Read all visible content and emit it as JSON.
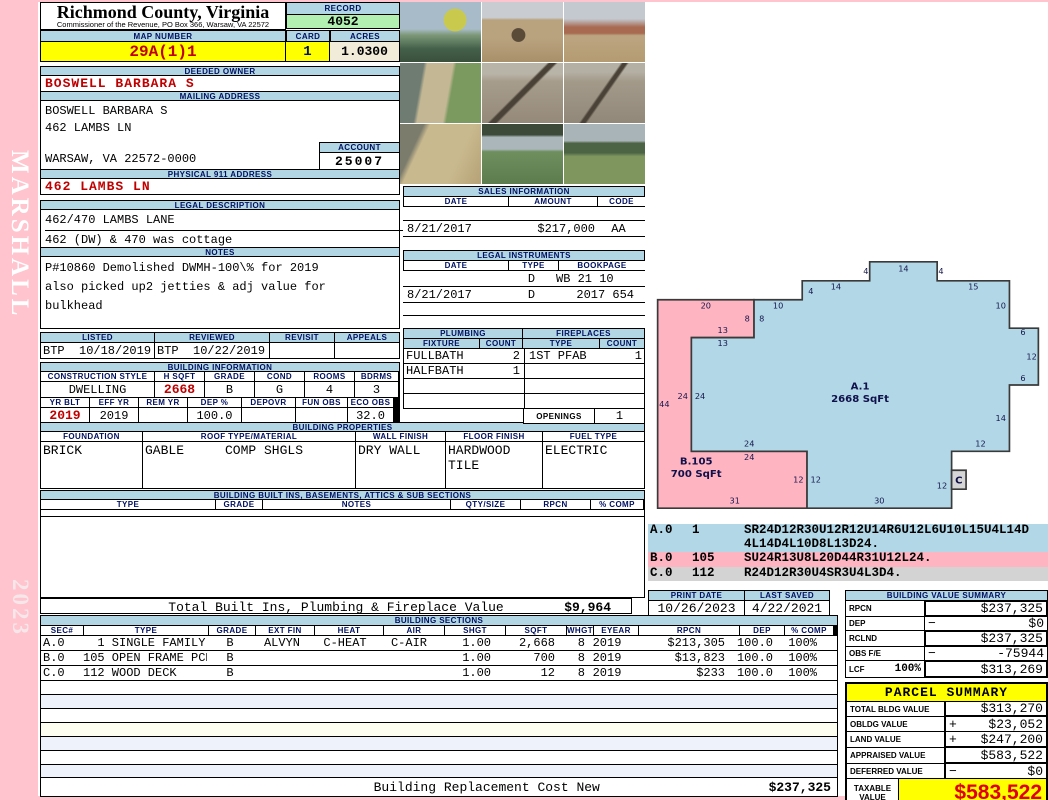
{
  "sidebar": {
    "vertical_top": "MARSHALL",
    "vertical_bottom": "2023"
  },
  "title": {
    "name": "Richmond County, Virginia",
    "subtitle": "Commissioner of the Revenue, PO Box 366, Warsaw, VA 22572"
  },
  "record": {
    "label": "RECORD",
    "value": "4052"
  },
  "map": {
    "label": "MAP NUMBER",
    "value": "29A(1)1",
    "card_label": "CARD",
    "card_value": "1",
    "acres_label": "ACRES",
    "acres_value": "1.0300"
  },
  "owner": {
    "deeded_label": "DEEDED OWNER",
    "deeded": "BOSWELL BARBARA S",
    "mailing_label": "MAILING ADDRESS",
    "mailing_line1": "BOSWELL BARBARA S",
    "mailing_line2": "462 LAMBS LN",
    "mailing_line3": "WARSAW, VA 22572-0000",
    "account_label": "ACCOUNT",
    "account": "25007",
    "physical_label": "PHYSICAL 911 ADDRESS",
    "physical": "462 LAMBS LN"
  },
  "legal": {
    "label": "LEGAL DESCRIPTION",
    "line1": "462/470 LAMBS LANE",
    "line2": "462 (DW) & 470 was cottage",
    "notes_label": "NOTES",
    "notes_line1": "P#10860 Demolished DWMH-100\\% for 2019",
    "notes_line2": "also picked up2 jetties & adj value for",
    "notes_line3": "bulkhead"
  },
  "review": {
    "listed_label": "LISTED",
    "listed": "BTP  10/18/2019",
    "reviewed_label": "REVIEWED",
    "reviewed": "BTP  10/22/2019",
    "revisit_label": "REVISIT",
    "revisit": "",
    "appeals_label": "APPEALS",
    "appeals": ""
  },
  "building_info": {
    "label": "BUILDING INFORMATION",
    "h1": [
      "CONSTRUCTION STYLE",
      "H SQFT",
      "GRADE",
      "COND",
      "ROOMS",
      "BDRMS"
    ],
    "v1": [
      "DWELLING",
      "2668",
      "B",
      "G",
      "4",
      "3"
    ],
    "h2": [
      "YR BLT",
      "EFF YR",
      "REM YR",
      "DEP %",
      "DEPOVR",
      "FUN OBS",
      "ECO OBS"
    ],
    "v2": [
      "2019",
      "2019",
      "",
      "100.0",
      "",
      "",
      "32.0"
    ]
  },
  "building_props": {
    "label": "BUILDING PROPERTIES",
    "headers": [
      "FOUNDATION",
      "ROOF TYPE/MATERIAL",
      "WALL FINISH",
      "FLOOR FINISH",
      "FUEL TYPE"
    ],
    "foundation": "BRICK",
    "roof_type": "GABLE",
    "roof_material": "COMP SHGLS",
    "wall": "DRY WALL",
    "floor_line1": "HARDWOOD",
    "floor_line2": "TILE",
    "fuel": "ELECTRIC"
  },
  "built_ins": {
    "label": "BUILDING BUILT INS, BASEMENTS, ATTICS & SUB SECTIONS",
    "headers": [
      "TYPE",
      "GRADE",
      "NOTES",
      "QTY/SIZE",
      "RPCN",
      "% COMP"
    ],
    "total_label": "Total Built Ins, Plumbing & Fireplace Value",
    "total_value": "$9,964"
  },
  "photos": {
    "items": [
      "waterfront tree",
      "construction sand",
      "brick foundation",
      "shore erosion",
      "water jetty",
      "water jetty far",
      "bulkhead sand",
      "lawn waterfront",
      "field trees"
    ]
  },
  "sales": {
    "label": "SALES INFORMATION",
    "headers": [
      "DATE",
      "AMOUNT",
      "CODE"
    ],
    "rows": [
      [
        "",
        "",
        ""
      ],
      [
        "8/21/2017",
        "$217,000",
        "AA"
      ],
      [
        "",
        "",
        ""
      ]
    ]
  },
  "instruments": {
    "label": "LEGAL INSTRUMENTS",
    "headers": [
      "DATE",
      "TYPE",
      "BOOKPAGE"
    ],
    "rows": [
      [
        "",
        "D",
        "WB 21 10"
      ],
      [
        "8/21/2017",
        "D",
        "2017 654"
      ],
      [
        "",
        "",
        ""
      ]
    ]
  },
  "plumbing": {
    "label": "PLUMBING",
    "fixture_label": "FIXTURE",
    "count_label": "COUNT",
    "rows": [
      [
        "FULLBATH",
        "2"
      ],
      [
        "HALFBATH",
        "1"
      ],
      [
        "",
        ""
      ],
      [
        "",
        ""
      ]
    ]
  },
  "fireplaces": {
    "label": "FIREPLACES",
    "type_label": "TYPE",
    "count_label": "COUNT",
    "rows": [
      [
        "1ST PFAB",
        "1"
      ],
      [
        "",
        ""
      ],
      [
        "",
        ""
      ],
      [
        "",
        ""
      ]
    ],
    "openings_label": "OPENINGS",
    "openings": "1"
  },
  "sketch": {
    "a_points": "0,0 24,0 24,12 54,12 54,0 66,0 66,-14 72,-14 72,-26 66,-26 66,-36 51,-36 51,-40 37,-40 37,-36 23,-36 23,-32 13,-32 13,-24 0,-24",
    "b_points": "0,0 0,-24 13,-24 13,-32 -7,-32 -7,12 24,12 24,0",
    "c_points": "54,4 57,4 57,8 54,8",
    "dim_labels": [
      {
        "t": "4",
        "u": 36.2,
        "v": -37.4
      },
      {
        "t": "14",
        "u": 44,
        "v": -38
      },
      {
        "t": "4",
        "u": 51.8,
        "v": -37.4
      },
      {
        "t": "14",
        "u": 30,
        "v": -34.2
      },
      {
        "t": "15",
        "u": 58.5,
        "v": -34.2
      },
      {
        "t": "4",
        "u": 24.8,
        "v": -33.2
      },
      {
        "t": "10",
        "u": 18,
        "v": -30.2
      },
      {
        "t": "20",
        "u": 3,
        "v": -30.2
      },
      {
        "t": "8",
        "u": 11.6,
        "v": -27.4
      },
      {
        "t": "8",
        "u": 14.6,
        "v": -27.4
      },
      {
        "t": "13",
        "u": 6.5,
        "v": -25
      },
      {
        "t": "13",
        "u": 6.5,
        "v": -22.2
      },
      {
        "t": "24",
        "u": -1.8,
        "v": -11
      },
      {
        "t": "24",
        "u": 1.8,
        "v": -11
      },
      {
        "t": "44",
        "u": -5.6,
        "v": -9.4
      },
      {
        "t": "24",
        "u": 12,
        "v": -1
      },
      {
        "t": "24",
        "u": 12,
        "v": 1.8
      },
      {
        "t": "12",
        "u": 22.2,
        "v": 6.6
      },
      {
        "t": "12",
        "u": 25.8,
        "v": 6.6
      },
      {
        "t": "31",
        "u": 9,
        "v": 11
      },
      {
        "t": "30",
        "u": 39,
        "v": 11
      },
      {
        "t": "12",
        "u": 52,
        "v": 7.8
      },
      {
        "t": "12",
        "u": 60,
        "v": -1
      },
      {
        "t": "14",
        "u": 64.2,
        "v": -6.4
      },
      {
        "t": "6",
        "u": 68.8,
        "v": -14.8
      },
      {
        "t": "12",
        "u": 70.6,
        "v": -19.4
      },
      {
        "t": "6",
        "u": 68.8,
        "v": -24.6
      },
      {
        "t": "10",
        "u": 64.2,
        "v": -30.2
      }
    ],
    "area_labels": [
      {
        "t": "A.1",
        "u": 35,
        "v": -13
      },
      {
        "t": "2668 SqFt",
        "u": 35,
        "v": -10.4
      },
      {
        "t": "B.105",
        "u": 1,
        "v": 2.8
      },
      {
        "t": "700 SqFt",
        "u": 1,
        "v": 5.4
      },
      {
        "t": "C",
        "u": 55.5,
        "v": 6.8
      }
    ],
    "codes": [
      {
        "sec": "A.0",
        "num": "1",
        "code1": "SR24D12R30U12R12U14R6U12L6U10L15U4L14D",
        "code2": "4L14D4L10D8L13D24."
      },
      {
        "sec": "B.0",
        "num": "105",
        "code1": "SU24R13U8L20D44R31U12L24.",
        "code2": ""
      },
      {
        "sec": "C.0",
        "num": "112",
        "code1": "R24D12R30U4SR3U4L3D4.",
        "code2": ""
      }
    ]
  },
  "print_info": {
    "print_label": "PRINT DATE",
    "print": "10/26/2023",
    "saved_label": "LAST SAVED",
    "saved": "4/22/2021"
  },
  "bvs": {
    "label": "BUILDING VALUE SUMMARY",
    "rows": [
      {
        "label": "RPCN",
        "sub": "",
        "sign": "",
        "value": "$237,325"
      },
      {
        "label": "DEP",
        "sub": "",
        "sign": "−",
        "value": "$0"
      },
      {
        "label": "RCLND",
        "sub": "",
        "sign": "",
        "value": "$237,325"
      },
      {
        "label": "OBS F/E",
        "sub": "",
        "sign": "−",
        "value": "-75944"
      },
      {
        "label": "LCF",
        "sub": "100%",
        "sign": "",
        "value": "$313,269"
      }
    ]
  },
  "sections": {
    "label": "BUILDING SECTIONS",
    "headers": [
      "SEC#",
      "TYPE",
      "GRADE",
      "EXT FIN",
      "HEAT",
      "AIR",
      "SHGT",
      "SQFT",
      "WHGT",
      "EYEAR",
      "RPCN",
      "DEP",
      "% COMP"
    ],
    "rows": [
      [
        "A.0",
        "  1 SINGLE FAMILY",
        "B",
        "ALVYN",
        "C-HEAT",
        "C-AIR",
        "1.00",
        "2,668",
        "8",
        "2019",
        "$213,305",
        "100.0",
        "100%"
      ],
      [
        "B.0",
        "105 OPEN FRAME PCH",
        "B",
        "",
        "",
        "",
        "1.00",
        "700",
        "8",
        "2019",
        "$13,823",
        "100.0",
        "100%"
      ],
      [
        "C.0",
        "112 WOOD DECK",
        "B",
        "",
        "",
        "",
        "1.00",
        "12",
        "8",
        "2019",
        "$233",
        "100.0",
        "100%"
      ]
    ],
    "bottom_label": "Building Replacement Cost New",
    "bottom_value": "$237,325"
  },
  "parcel": {
    "label": "PARCEL SUMMARY",
    "rows": [
      {
        "label": "TOTAL BLDG VALUE",
        "sign": "",
        "value": "$313,270"
      },
      {
        "label": "OBLDG VALUE",
        "sign": "+",
        "value": "$23,052"
      },
      {
        "label": "LAND VALUE",
        "sign": "+",
        "value": "$247,200"
      },
      {
        "label": "APPRAISED VALUE",
        "sign": "",
        "value": "$583,522"
      },
      {
        "label": "DEFERRED VALUE",
        "sign": "−",
        "value": "$0"
      }
    ],
    "taxable_label1": "TAXABLE",
    "taxable_label2": "VALUE",
    "taxable_value": "$583,522"
  }
}
